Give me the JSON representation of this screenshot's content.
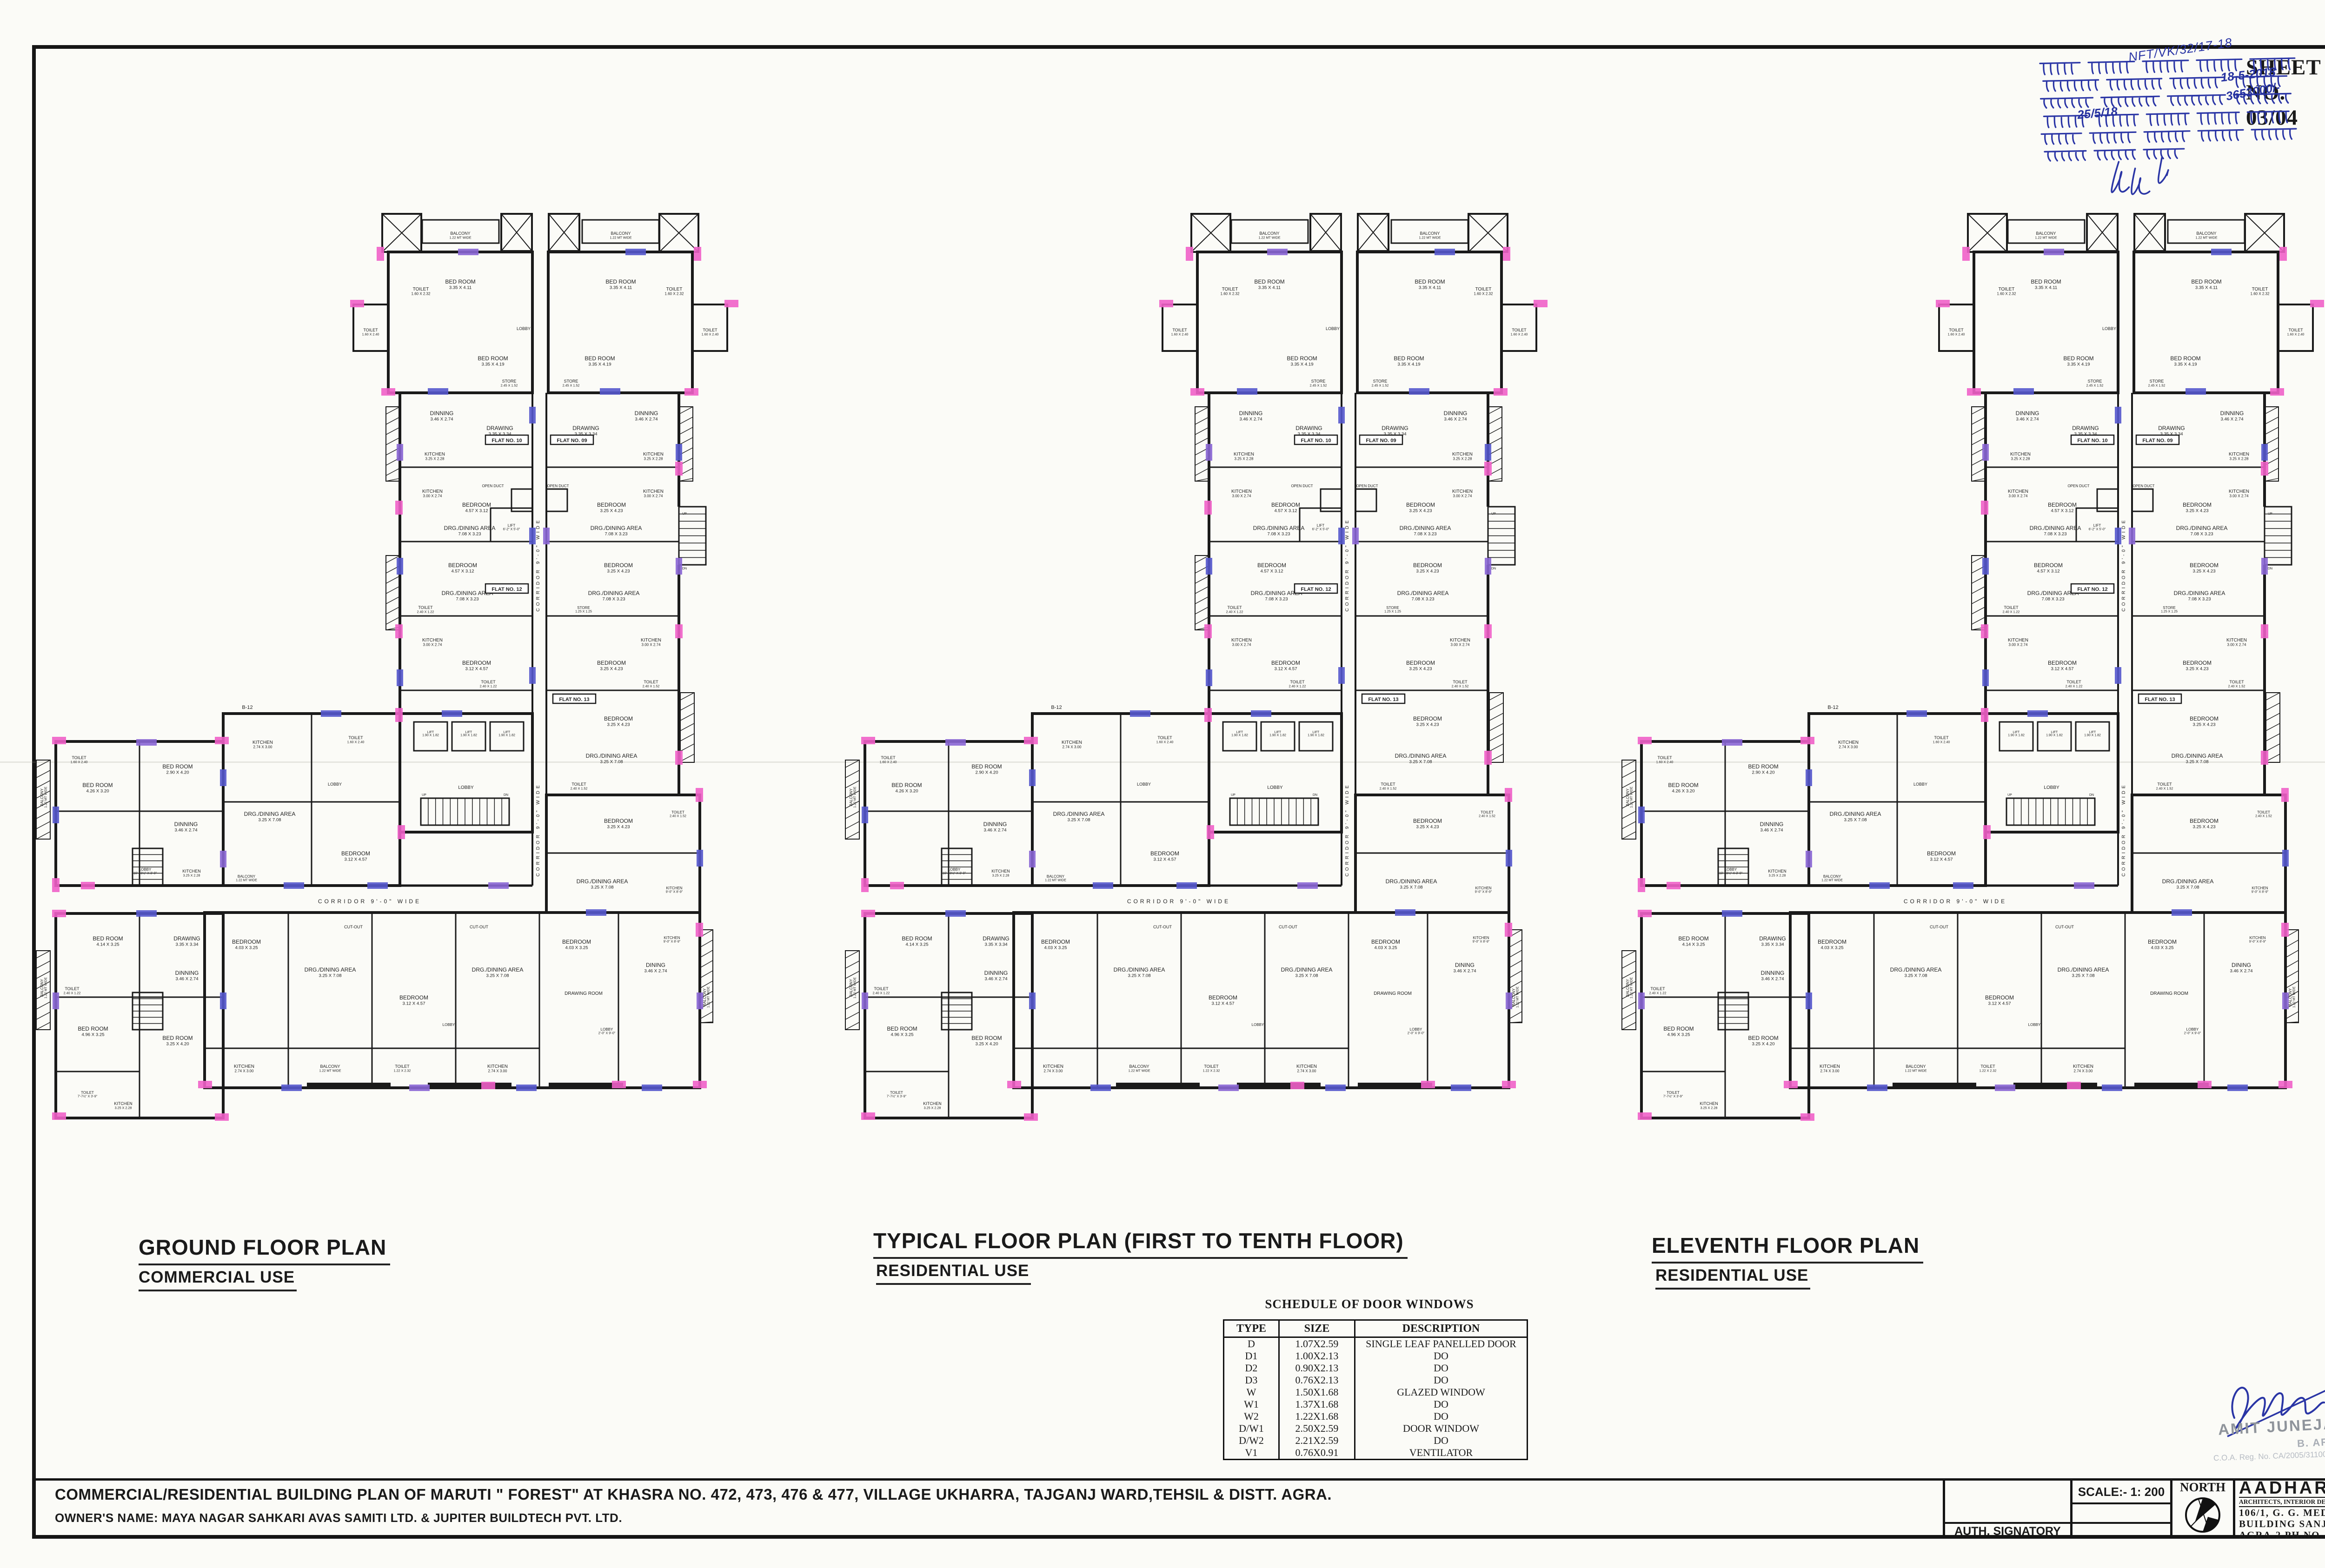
{
  "sheet": {
    "sheet_no": "SHEET NO. 03/04",
    "stamp": {
      "ref": "NFT/VK/32/17-18",
      "lines": [
        "बाद संख्या ..... के क्रम में उपाध्यक्ष",
        "महोदय की स्वीकृति दिनांक 18-5-2018",
        "क्रम में कुल शमन धनराशि रु0 3653000/-",
        "दिनांक 25/5/18 को जमा कर दिये जा",
        "के उपरान्त मानचित्र स्वीकृत/ शमन मानचित्र",
        "निर्गत किया जाता है।"
      ],
      "numerals": {
        "date1": "18-5-2018",
        "amount": "3653000/-",
        "date2": "25/5/18"
      }
    }
  },
  "plans": [
    {
      "title": "GROUND FLOOR PLAN",
      "use": "COMMERCIAL USE"
    },
    {
      "title": "TYPICAL FLOOR PLAN (FIRST TO TENTH FLOOR)",
      "use": "RESIDENTIAL USE"
    },
    {
      "title": "ELEVENTH FLOOR PLAN",
      "use": "RESIDENTIAL USE"
    }
  ],
  "plan_annotations": {
    "corridor": "CORRIDOR 9'-0\" WIDE",
    "flat_badges": [
      "FLAT NO. 09",
      "FLAT NO. 10",
      "FLAT NO. 12",
      "FLAT NO. 13"
    ],
    "block_label": "B-12",
    "stair_up": "UP",
    "stair_dn": "DN",
    "rooms": {
      "balcony": {
        "name": "BALCONY",
        "dim": "1.22 MT WIDE"
      },
      "toilet_a": {
        "name": "TOILET",
        "dim": "1.22 X 2.32"
      },
      "toilet_b": {
        "name": "TOILET",
        "dim": "1.60 X 2.32"
      },
      "toilet_c": {
        "name": "TOILET",
        "dim": "1.60 X 2.40"
      },
      "toilet_d": {
        "name": "TOILET",
        "dim": "2.40 X 1.22"
      },
      "toilet_e": {
        "name": "TOILET",
        "dim": "2.40 X 1.52"
      },
      "toilet_f": {
        "name": "TOILET",
        "dim": "7'-7½\" X 3'-9\""
      },
      "bed_a": {
        "name": "BED ROOM",
        "dim": "3.35 X 4.11"
      },
      "bed_b": {
        "name": "BED ROOM",
        "dim": "3.35 X 4.19"
      },
      "bed_c": {
        "name": "BED ROOM",
        "dim": "4.26 X 3.20"
      },
      "bed_d": {
        "name": "BEDROOM",
        "dim": "4.57 X 3.12"
      },
      "bed_e": {
        "name": "BEDROOM",
        "dim": "3.25 X 4.23"
      },
      "bed_f": {
        "name": "BEDROOM",
        "dim": "4.03 X 3.25"
      },
      "bed_g": {
        "name": "BEDROOM",
        "dim": "3.12 X 4.57"
      },
      "bed_h": {
        "name": "BED ROOM",
        "dim": "4.14 X 3.25"
      },
      "bed_i": {
        "name": "BED ROOM",
        "dim": "4.96 X 3.25"
      },
      "bed_j": {
        "name": "BED ROOM",
        "dim": "3.25 X 4.20"
      },
      "bed_k": {
        "name": "BED ROOM",
        "dim": "2.90 X 4.20"
      },
      "store_a": {
        "name": "STORE",
        "dim": "2.45 X 1.52"
      },
      "store_b": {
        "name": "STORE",
        "dim": "1.25 X 1.25"
      },
      "dinning": {
        "name": "DINNING",
        "dim": "3.46 X 2.74"
      },
      "dining": {
        "name": "DINING",
        "dim": "3.46 X 2.74"
      },
      "drawing": {
        "name": "DRAWING",
        "dim": "3.35 X 3.34"
      },
      "drawing_room": {
        "name": "DRAWING ROOM"
      },
      "kitchen_a": {
        "name": "KITCHEN",
        "dim": "3.25 X 2.28"
      },
      "kitchen_b": {
        "name": "KITCHEN",
        "dim": "3.00 X 2.74"
      },
      "kitchen_c": {
        "name": "KITCHEN",
        "dim": "2.74 X 3.00"
      },
      "kitchen_d": {
        "name": "KITCHEN",
        "dim": "9'-0\" X 8'-9\""
      },
      "drg": {
        "name": "DRG./DINING AREA",
        "dim": "7.08 X 3.23"
      },
      "drg2": {
        "name": "DRG./DINING AREA",
        "dim": "3.25 X 7.08"
      },
      "lobby": {
        "name": "LOBBY"
      },
      "lobby_a": {
        "name": "LOBBY",
        "dim": "4'-0\" X 3'-6\""
      },
      "lobby_b": {
        "name": "LOBBY",
        "dim": "10'-10½\" X 3'-0\""
      },
      "lobby_c": {
        "name": "LOBBY",
        "dim": "2'-0\" X 9'-0\""
      },
      "lift_a": {
        "name": "LIFT",
        "dim": "1.90 X 1.82"
      },
      "lift_b": {
        "name": "LIFT",
        "dim": "6'-2\" X 5'-0\""
      },
      "open_duct": {
        "name": "OPEN DUCT"
      },
      "cut_out": {
        "name": "CUT-OUT"
      }
    }
  },
  "schedule": {
    "heading": "SCHEDULE OF DOOR WINDOWS",
    "columns": [
      "TYPE",
      "SIZE",
      "DESCRIPTION"
    ],
    "rows": [
      [
        "D",
        "1.07X2.59",
        "SINGLE LEAF PANELLED DOOR"
      ],
      [
        "D1",
        "1.00X2.13",
        "DO"
      ],
      [
        "D2",
        "0.90X2.13",
        "DO"
      ],
      [
        "D3",
        "0.76X2.13",
        "DO"
      ],
      [
        "W",
        "1.50X1.68",
        "GLAZED WINDOW"
      ],
      [
        "W1",
        "1.37X1.68",
        "DO"
      ],
      [
        "W2",
        "1.22X1.68",
        "DO"
      ],
      [
        "D/W1",
        "2.50X2.59",
        "DOOR WINDOW"
      ],
      [
        "D/W2",
        "2.21X2.59",
        "DO"
      ],
      [
        "V1",
        "0.76X0.91",
        "VENTILATOR"
      ]
    ]
  },
  "title_block": {
    "project": "COMMERCIAL/RESIDENTIAL BUILDING PLAN OF MARUTI \" FOREST\" AT KHASRA NO. 472, 473, 476 & 477, VILLAGE UKHARRA, TAJGANJ WARD,TEHSIL & DISTT. AGRA.",
    "owner": "OWNER'S NAME: MAYA NAGAR SAHKARI AVAS SAMITI LTD. & JUPITER BUILDTECH PVT. LTD.",
    "auth": "AUTH. SIGNATORY",
    "scale": "SCALE:- 1: 200",
    "north": "NORTH",
    "firm": {
      "name": "AADHARSHILA",
      "tagline": "ARCHITECTS, INTERIOR DESIGNERS, VAASTU CONSULTANTS",
      "address1": "106/1, G. G. MEDICAL INSTT.",
      "address2": "BUILDING SANJAY PLACE",
      "address3": "AGRA-2  PH.NO.  4000820"
    }
  },
  "signature_stamp": {
    "name": "AMIT JUNEJA",
    "degree": "B. ARCH",
    "reg": "C.O.A. Reg. No. CA/2005/31100"
  },
  "colors": {
    "pink": "#f060c8",
    "blue": "#5558cc",
    "purple": "#8a66d4",
    "ink": "#1a1a1a",
    "stamp_blue": "#2a35a5"
  }
}
